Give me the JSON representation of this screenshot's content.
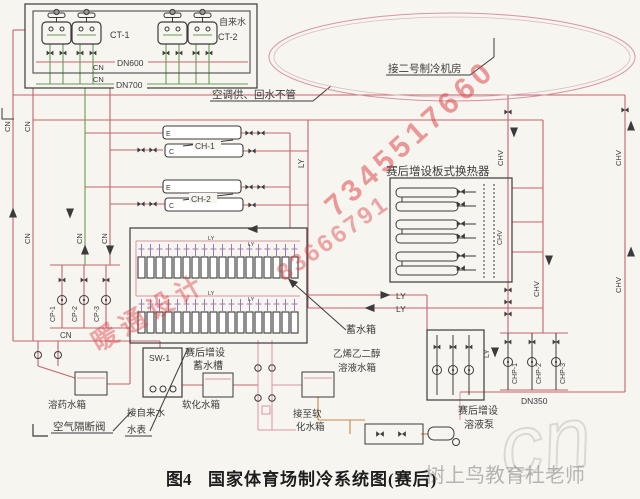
{
  "caption": {
    "fig": "图4",
    "title": "国家体育场制冷系统图(赛后)"
  },
  "cooling_plant": {
    "tap_water": "自来水",
    "ct1": "CT-1",
    "ct2": "CT-2",
    "dn600": "DN600",
    "dn700": "DN700",
    "note": "空调供、回水不管"
  },
  "machine_room_note": "接二号制冷机房",
  "chillers": {
    "ch1": "CH-1",
    "ch2": "CH-2",
    "evap": "E",
    "cond": "C"
  },
  "plate_hx": {
    "label": "赛后增设板式换热器"
  },
  "storage": {
    "tank": "蓄水箱",
    "added1": "赛后增设",
    "added2": "蓄水槽"
  },
  "treatment": {
    "sw1": "SW-1",
    "chemical": "溶药水箱",
    "air_gap": "空气隔断阀",
    "tap_in": "接自来水",
    "meter": "水表",
    "softened": "软化水箱",
    "to_soft1": "接至软",
    "to_soft2": "化水箱",
    "glycol1": "乙烯乙二醇",
    "glycol2": "溶液水箱"
  },
  "pumps": {
    "cp1": "CP-1",
    "cp2": "CP-2",
    "cp3": "CP-3",
    "chp1": "CHP-1",
    "chp2": "CHP-2",
    "chp3": "CHP-3",
    "dn350": "DN350",
    "sol1": "赛后增设",
    "sol2": "溶液泵"
  },
  "pipes": {
    "cn": "CN",
    "ly": "LY",
    "chv": "CHV"
  },
  "watermarks": {
    "phone": "7345517660",
    "digits": "83666791",
    "hvac": "暖通设计",
    "teacher": "树上鸟教育杜老师",
    "site": "cn"
  }
}
